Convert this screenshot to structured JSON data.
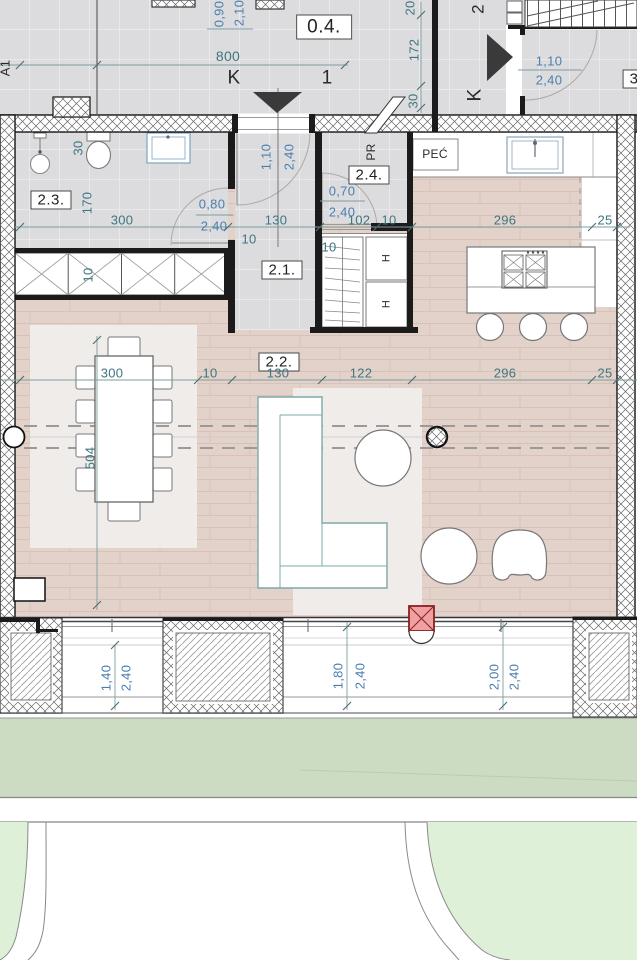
{
  "colors": {
    "dim_blue": "#4a7fae",
    "dim_teal": "#3e7680",
    "floor_wood": "#e3d2ca",
    "floor_gray": "#dcdcde",
    "wood_line": "#d7c1b8",
    "rug": "#efecea",
    "lawn": "#cbdcc3",
    "lawn_light": "#def0d8",
    "column_red": "#efa0a0",
    "couch_line": "#7fa8a8",
    "wall_black": "#1b1b1b"
  },
  "plan": {
    "axes": {
      "a1": "A1",
      "k_top": "K",
      "col_1": "1",
      "col_2": "2",
      "k_right": "K"
    },
    "rooms": {
      "r04": "0.4.",
      "r21": "2.1.",
      "r22": "2.2.",
      "r23": "2.3.",
      "r24": "2.4.",
      "r3": "3"
    },
    "fixtures": {
      "pec": "PEĆ",
      "pr": "PR",
      "h_top": "H",
      "h_bottom": "H"
    },
    "dims": {
      "top_door_w": "0,90",
      "top_door_h": "2,10",
      "top_span": "800",
      "v20": "20",
      "v172": "172",
      "v30": "30",
      "right_door_w": "1,10",
      "right_door_h": "2,40",
      "entry_w": "1,10",
      "entry_h": "2,40",
      "wc_niche": "30",
      "bath_dep": "170",
      "bath_door_w": "0,80",
      "bath_door_h": "2,40",
      "store_door_w": "0,70",
      "store_door_h": "2,40",
      "row1": {
        "a": "300",
        "b": "130",
        "c": "102",
        "d": "10",
        "e": "296",
        "f": "25"
      },
      "row2": {
        "a": "300",
        "b": "10",
        "c": "130",
        "d": "122",
        "e": "296",
        "f": "25"
      },
      "band10": "10",
      "hall10": "10",
      "closet10": "10",
      "room_depth": "504",
      "win1_w": "1,40",
      "win1_h": "2,40",
      "win2_w": "1,80",
      "win2_h": "2,40",
      "win3_w": "2,00",
      "win3_h": "2,40"
    }
  }
}
